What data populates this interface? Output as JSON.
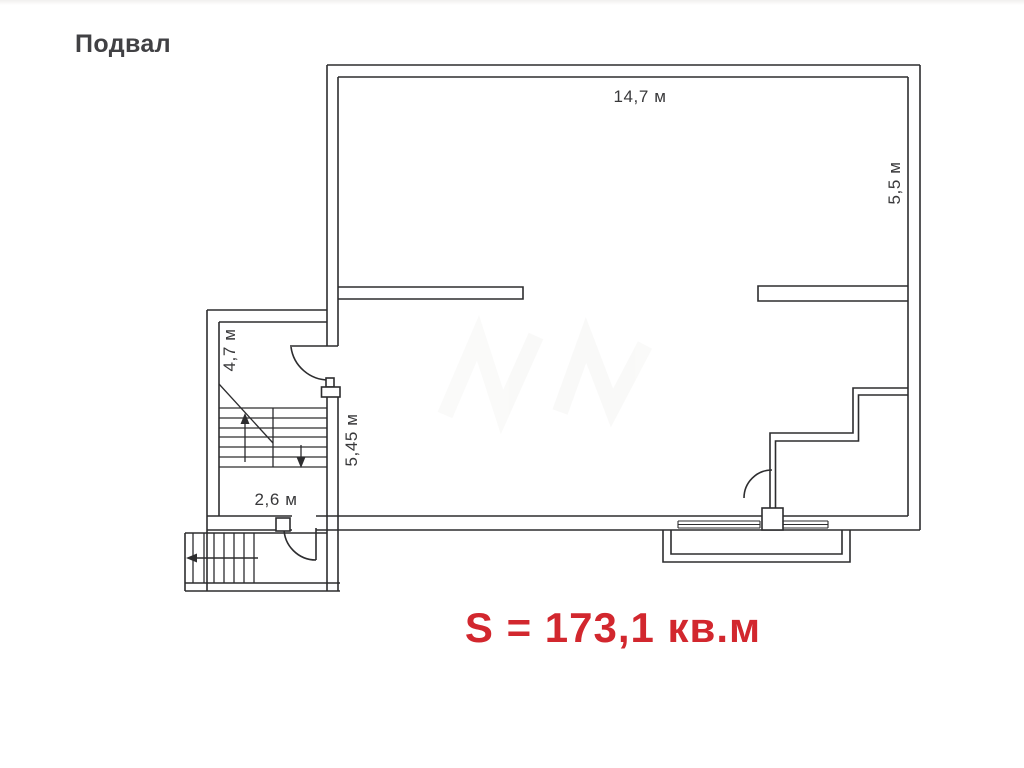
{
  "page": {
    "title": "Подвал"
  },
  "plan": {
    "area_label": "S = 173,1 кв.м",
    "dimensions": {
      "main_width_top": "14,7 м",
      "main_height_right": "5,5 м",
      "stair_annex_height": "4,7 м",
      "left_inner_height": "5,45 м",
      "stair_annex_width": "2,6 м"
    },
    "colors": {
      "wall_line": "#2d2d2f",
      "dimension_text": "#38383a",
      "title_text": "#414144",
      "area_text": "#d2272e",
      "background": "#ffffff"
    }
  }
}
